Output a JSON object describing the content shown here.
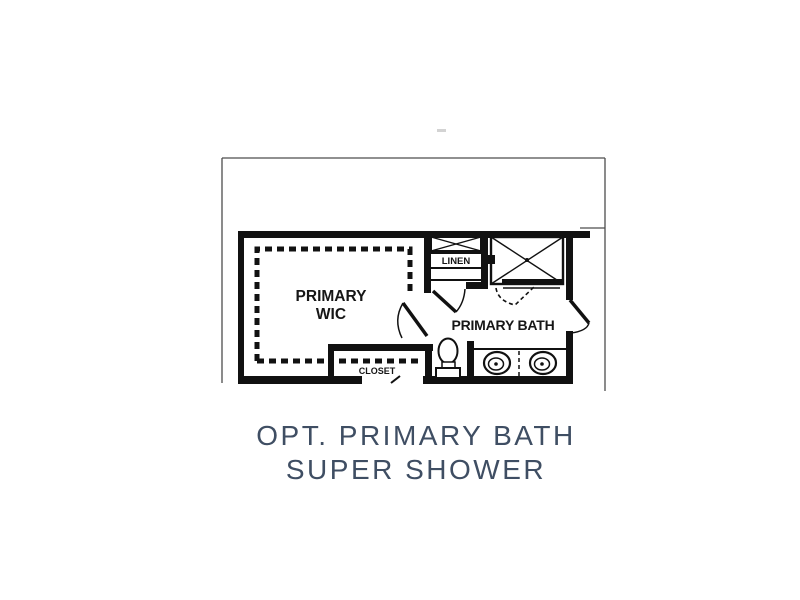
{
  "page": {
    "background": "#ffffff",
    "type": "floor-plan-rendering"
  },
  "colors": {
    "wall": "#111111",
    "boundary": "#4d4d4d",
    "caption_text": "#3f4e63",
    "faint_mark": "#c4c4c4",
    "label_text": "#161616"
  },
  "floor_plan": {
    "rooms": [
      {
        "id": "primary-wic",
        "label_line1": "PRIMARY",
        "label_line2": "WIC"
      },
      {
        "id": "linen",
        "label": "LINEN"
      },
      {
        "id": "primary-bath",
        "label": "PRIMARY BATH"
      },
      {
        "id": "closet",
        "label": "CLOSET"
      }
    ],
    "fixtures": [
      "super-shower-with-x-pattern",
      "linen-cabinet-x-pattern",
      "toilet",
      "double-vanity-two-sinks",
      "wic-dashed-shelving",
      "closet-dashed-shelf",
      "shower-head"
    ],
    "door_symbols": [
      "wic-entry-door-swing",
      "bath-entry-door-swing",
      "bath-right-door-swing",
      "shower-door-dashed-swing",
      "closet-door-tick"
    ]
  },
  "caption": {
    "line1": "OPT. PRIMARY BATH",
    "line2": "SUPER SHOWER",
    "color": "#3f4e63"
  }
}
